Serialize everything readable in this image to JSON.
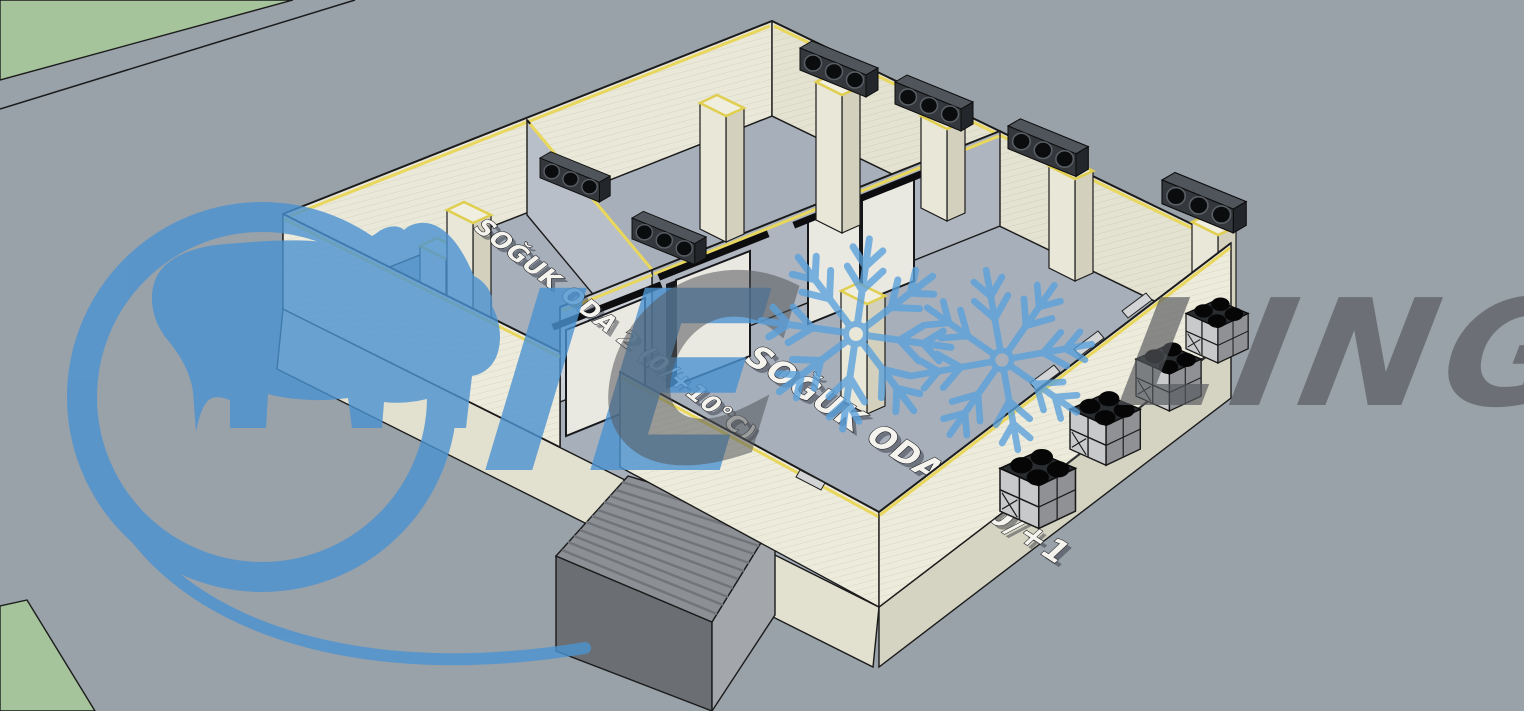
{
  "viewport": {
    "width": 1524,
    "height": 711,
    "background": "#99A1A9"
  },
  "branding": {
    "watermark_text_left": "IE",
    "watermark_text_c": "C",
    "watermark_text_right": "LING",
    "logo": "rhino-in-ring",
    "blue": "#4B93D2",
    "gray": "#55585C",
    "snowflake_blue": "#59A1DC"
  },
  "labels": {
    "room2": "SOĞUK ODA 2 (0/+10°C)",
    "room3": "SOĞUK ODA 3 (0/+1"
  },
  "scene": {
    "ground_color": "#99A1A9",
    "grass_color": "#A6C49B",
    "wall_color": "#EAE8D9",
    "panel_edge_color": "#E8D75C",
    "floor_color": "#A7AFBA",
    "evaporators": 6,
    "condensers": 4,
    "sliding_doors": 3,
    "snowflakes": 2
  }
}
